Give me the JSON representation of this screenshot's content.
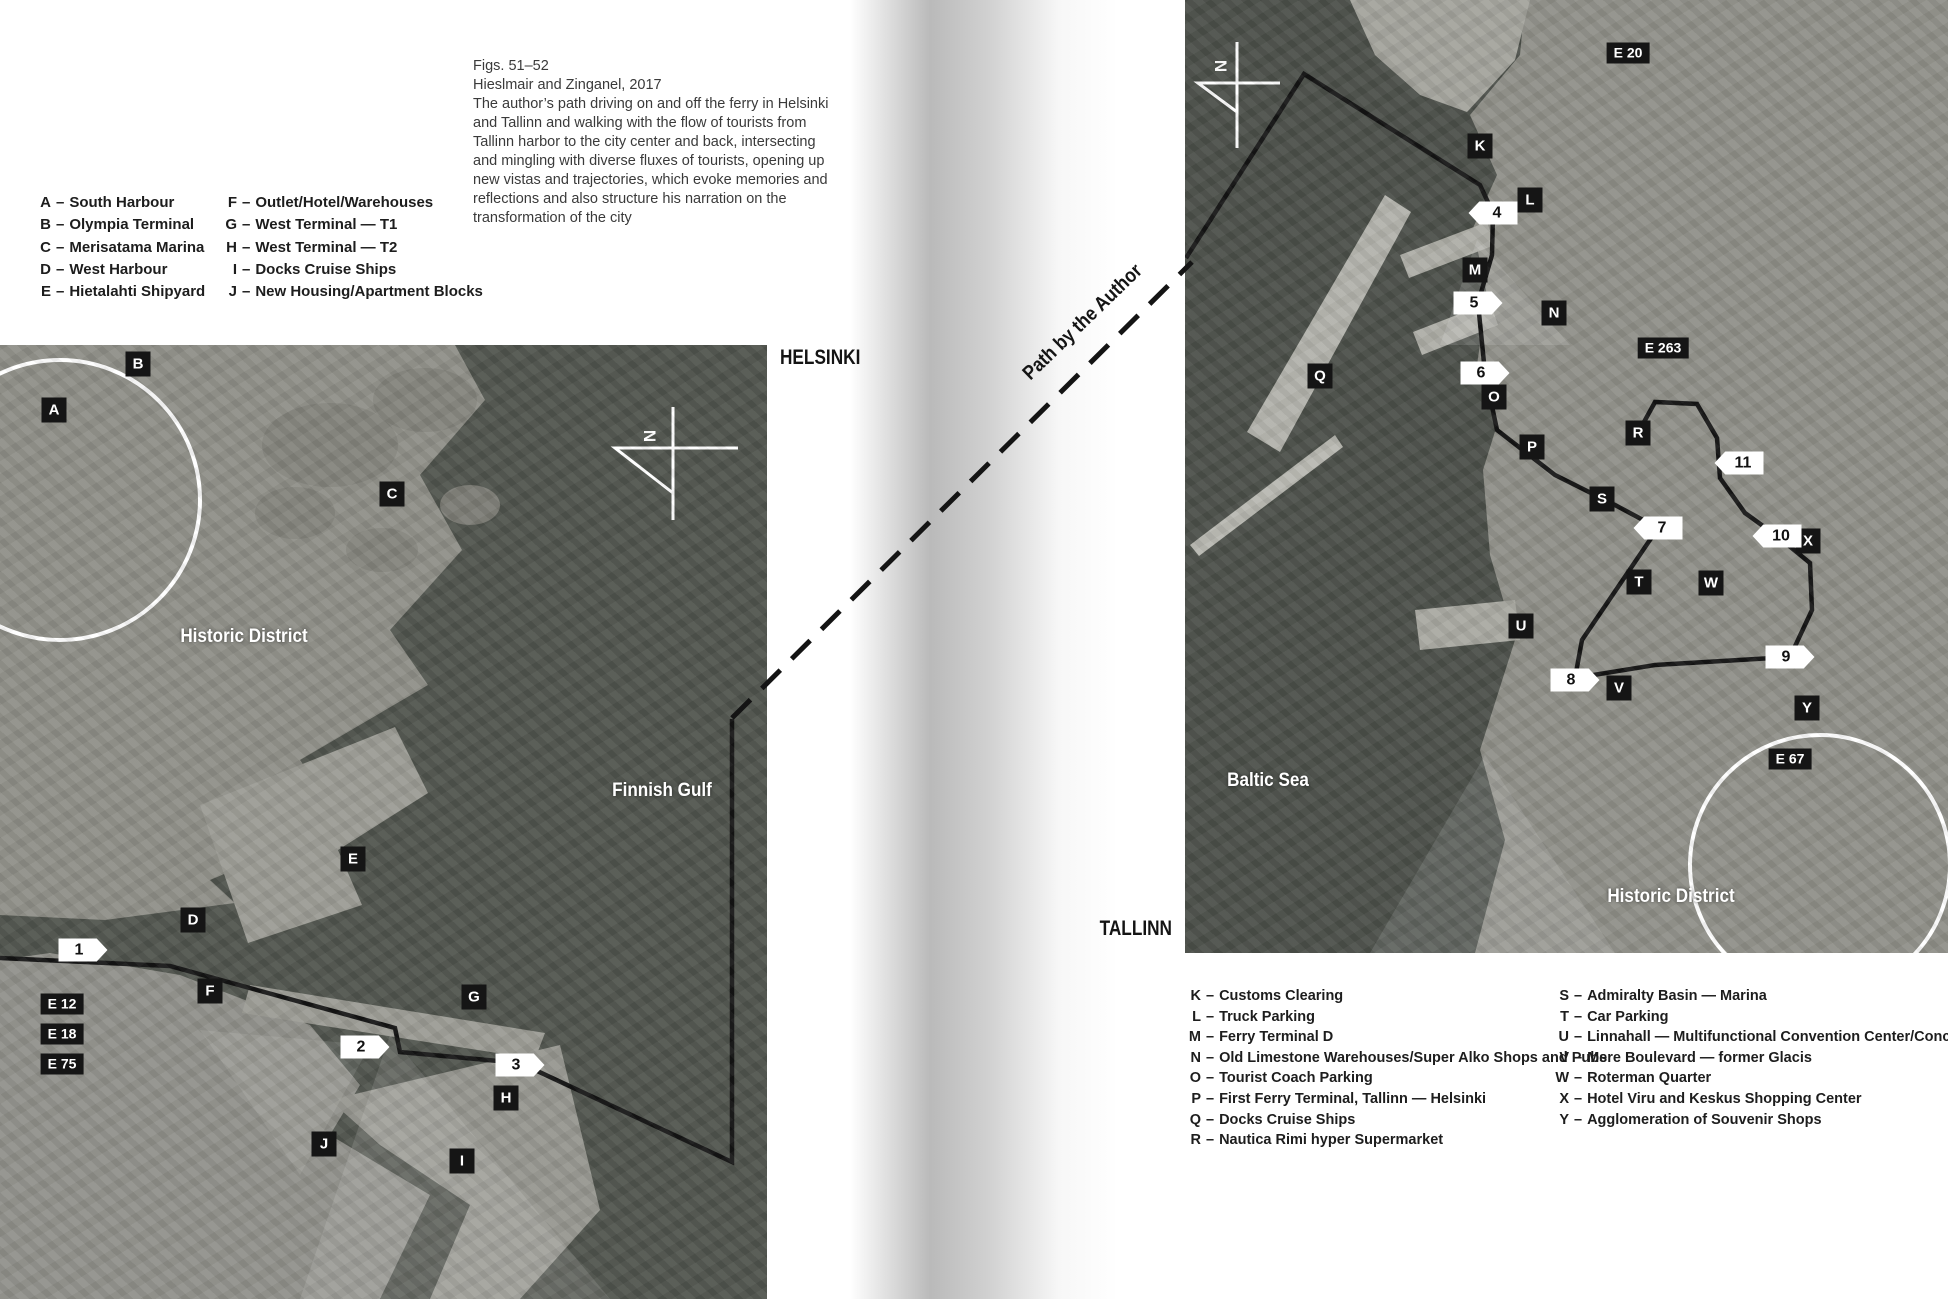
{
  "titles": {
    "helsinki": "HELSINKI",
    "tallinn": "TALLINN"
  },
  "path_label": "Path by the Author",
  "compass_label": "N",
  "caption": {
    "line1": "Figs. 51–52",
    "line2": "Hieslmair and Zinganel, 2017",
    "body": "The author’s path driving on and off the ferry in Helsinki and Tallinn and walking with the flow of tourists from Tallinn harbor to the city center and back, intersecting and mingling with diverse fluxes of tourists, opening up new vistas and trajectories, which evoke memories and reflections and also structure his narration on the transformation of the city"
  },
  "legend_separator": "–",
  "legend_left": {
    "col1": [
      {
        "key": "A",
        "label": "South Harbour"
      },
      {
        "key": "B",
        "label": "Olympia Terminal"
      },
      {
        "key": "C",
        "label": "Merisatama Marina"
      },
      {
        "key": "D",
        "label": "West Harbour"
      },
      {
        "key": "E",
        "label": "Hietalahti Shipyard"
      }
    ],
    "col2": [
      {
        "key": "F",
        "label": "Outlet/Hotel/Warehouses"
      },
      {
        "key": "G",
        "label": "West Terminal — T1"
      },
      {
        "key": "H",
        "label": "West Terminal — T2"
      },
      {
        "key": "I",
        "label": "Docks Cruise Ships"
      },
      {
        "key": "J",
        "label": "New Housing/Apartment Blocks"
      }
    ]
  },
  "legend_right": {
    "col1": [
      {
        "key": "K",
        "label": "Customs Clearing"
      },
      {
        "key": "L",
        "label": "Truck Parking"
      },
      {
        "key": "M",
        "label": "Ferry Terminal D"
      },
      {
        "key": "N",
        "label": "Old Limestone Warehouses/Super Alko Shops and Pubs"
      },
      {
        "key": "O",
        "label": "Tourist Coach Parking"
      },
      {
        "key": "P",
        "label": "First Ferry Terminal, Tallinn — Helsinki"
      },
      {
        "key": "Q",
        "label": "Docks Cruise Ships"
      },
      {
        "key": "R",
        "label": "Nautica Rimi hyper Supermarket"
      }
    ],
    "col2": [
      {
        "key": "S",
        "label": "Admiralty Basin — Marina"
      },
      {
        "key": "T",
        "label": "Car Parking"
      },
      {
        "key": "U",
        "label": "Linnahall — Multifunctional Convention Center/Concert Hall"
      },
      {
        "key": "V",
        "label": "Mere Boulevard — former Glacis"
      },
      {
        "key": "W",
        "label": "Roterman Quarter"
      },
      {
        "key": "X",
        "label": "Hotel Viru and Keskus Shopping Center"
      },
      {
        "key": "Y",
        "label": "Agglomeration of Souvenir Shops"
      }
    ]
  },
  "helsinki_map": {
    "water_labels": [
      {
        "text": "Historic District",
        "x": 244,
        "y": 292
      },
      {
        "text": "Finnish Gulf",
        "x": 662,
        "y": 446
      }
    ],
    "letter_markers": [
      {
        "text": "A",
        "x": 54,
        "y": 65
      },
      {
        "text": "B",
        "x": 138,
        "y": 19
      },
      {
        "text": "C",
        "x": 392,
        "y": 149
      },
      {
        "text": "D",
        "x": 193,
        "y": 575
      },
      {
        "text": "E",
        "x": 353,
        "y": 514
      },
      {
        "text": "F",
        "x": 210,
        "y": 646
      },
      {
        "text": "G",
        "x": 474,
        "y": 652
      },
      {
        "text": "H",
        "x": 506,
        "y": 753
      },
      {
        "text": "I",
        "x": 462,
        "y": 816
      },
      {
        "text": "J",
        "x": 324,
        "y": 799
      }
    ],
    "route_markers": [
      {
        "text": "E 12",
        "x": 62,
        "y": 659
      },
      {
        "text": "E 18",
        "x": 62,
        "y": 689
      },
      {
        "text": "E 75",
        "x": 62,
        "y": 719
      }
    ],
    "number_markers": [
      {
        "text": "1",
        "x": 83,
        "y": 605,
        "dir": "right"
      },
      {
        "text": "2",
        "x": 365,
        "y": 702,
        "dir": "right"
      },
      {
        "text": "3",
        "x": 520,
        "y": 720,
        "dir": "right"
      }
    ]
  },
  "tallinn_map": {
    "water_labels": [
      {
        "text": "Baltic Sea",
        "x": 83,
        "y": 781
      },
      {
        "text": "Historic District",
        "x": 486,
        "y": 897
      }
    ],
    "letter_markers": [
      {
        "text": "K",
        "x": 295,
        "y": 146
      },
      {
        "text": "L",
        "x": 345,
        "y": 200
      },
      {
        "text": "M",
        "x": 290,
        "y": 270
      },
      {
        "text": "N",
        "x": 369,
        "y": 313
      },
      {
        "text": "O",
        "x": 309,
        "y": 397
      },
      {
        "text": "P",
        "x": 347,
        "y": 447
      },
      {
        "text": "Q",
        "x": 135,
        "y": 376
      },
      {
        "text": "R",
        "x": 453,
        "y": 433
      },
      {
        "text": "S",
        "x": 417,
        "y": 499
      },
      {
        "text": "T",
        "x": 454,
        "y": 582
      },
      {
        "text": "U",
        "x": 336,
        "y": 626
      },
      {
        "text": "V",
        "x": 434,
        "y": 688
      },
      {
        "text": "W",
        "x": 526,
        "y": 583
      },
      {
        "text": "X",
        "x": 623,
        "y": 541
      },
      {
        "text": "Y",
        "x": 622,
        "y": 708
      }
    ],
    "route_markers": [
      {
        "text": "E 20",
        "x": 443,
        "y": 53
      },
      {
        "text": "E 263",
        "x": 478,
        "y": 348
      },
      {
        "text": "E 67",
        "x": 605,
        "y": 759
      }
    ],
    "number_markers": [
      {
        "text": "4",
        "x": 308,
        "y": 213,
        "dir": "left"
      },
      {
        "text": "5",
        "x": 293,
        "y": 303,
        "dir": "right"
      },
      {
        "text": "6",
        "x": 300,
        "y": 373,
        "dir": "right"
      },
      {
        "text": "7",
        "x": 473,
        "y": 528,
        "dir": "left"
      },
      {
        "text": "8",
        "x": 390,
        "y": 680,
        "dir": "right"
      },
      {
        "text": "9",
        "x": 605,
        "y": 657,
        "dir": "right"
      },
      {
        "text": "10",
        "x": 592,
        "y": 536,
        "dir": "left"
      },
      {
        "text": "11",
        "x": 554,
        "y": 463,
        "dir": "left"
      }
    ]
  },
  "colors": {
    "marker_bg": "#151515",
    "marker_text": "#ffffff",
    "number_bg": "#ffffff",
    "number_text": "#111111",
    "path": "#141414",
    "circle": "#ffffff",
    "water_helsinki": "#50544d",
    "water_tallinn": "#4b4f49",
    "land": "#8f8f88"
  }
}
